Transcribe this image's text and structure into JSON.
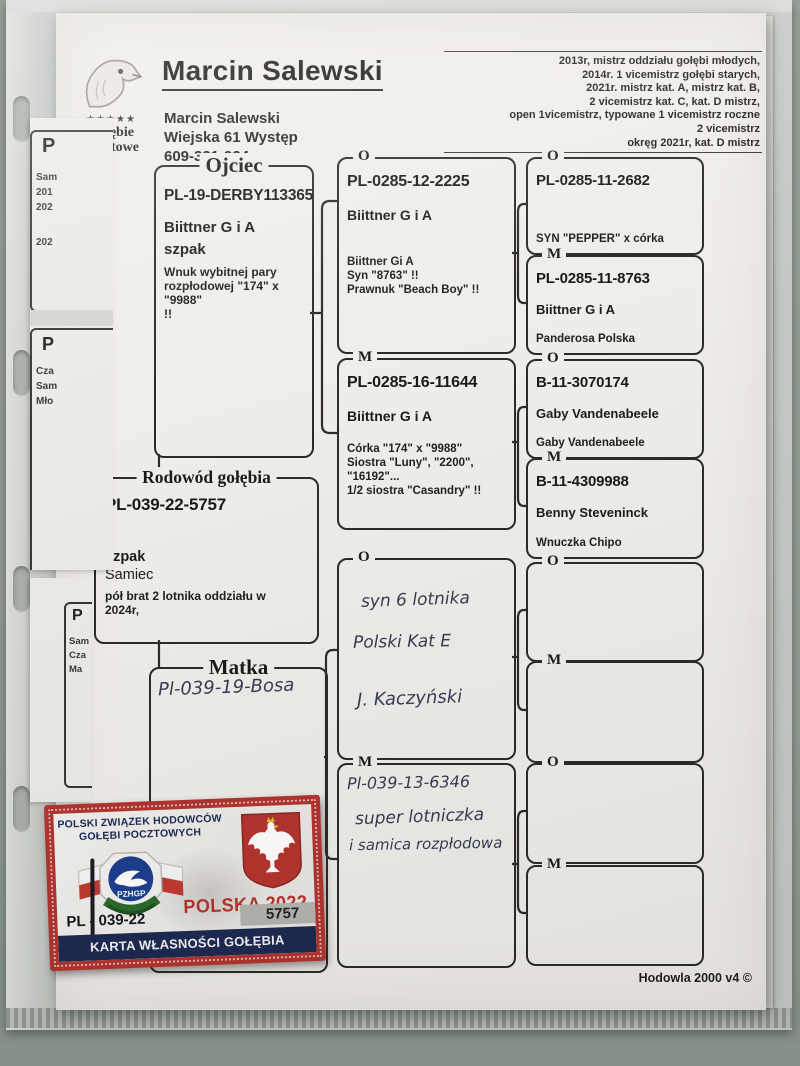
{
  "header": {
    "logo": {
      "stars": "★★★★★",
      "name_line1": "Gołębie",
      "name_line2": "Pocztowe"
    },
    "title": "Marcin Salewski",
    "address_lines": [
      "Marcin Salewski",
      "Wiejska 61 Występ",
      "609-331-924"
    ],
    "achievements": [
      "2013r, mistrz oddziału gołębi młodych,",
      "2014r. 1 vicemistrz gołębi starych,",
      "2021r. mistrz kat. A, mistrz kat. B,",
      "2 vicemistrz kat. C, kat. D mistrz,",
      "open 1vicemistrz, typowane 1 vicemistrz roczne",
      "2 vicemistrz",
      "okręg 2021r, kat. D mistrz"
    ]
  },
  "pedigree": {
    "subject": {
      "legend": "Rodowód gołębia",
      "ring": "PL-039-22-5757",
      "color": "szpak",
      "sex": "Samiec",
      "note_lines": [
        "pół brat 2 lotnika oddziału w",
        "2024r,"
      ]
    },
    "father": {
      "legend": "Ojciec",
      "ring": "PL-19-DERBY113365",
      "strain": "Biittner G i A",
      "color": "szpak",
      "note_lines": [
        "Wnuk wybitnej pary",
        "rozpłodowej \"174\" x \"9988\"",
        "!!"
      ]
    },
    "mother": {
      "legend": "Matka",
      "handwritten": "Pl-039-19-Bosa"
    },
    "gen2": [
      {
        "legend": "O",
        "ring": "PL-0285-12-2225",
        "strain": "Biittner G i A",
        "notes": [
          "Biittner Gi A",
          "Syn \"8763\" !!",
          "Prawnuk \"Beach Boy\" !!"
        ]
      },
      {
        "legend": "M",
        "ring": "PL-0285-16-11644",
        "strain": "Biittner G i A",
        "notes": [
          "Córka \"174\" x \"9988\"",
          "Siostra \"Luny\", \"2200\",",
          "\"16192\"...",
          "1/2 siostra \"Casandry\" !!"
        ]
      },
      {
        "legend": "O",
        "handwritten": [
          "syn 6 lotnika",
          "Polski Kat E",
          "J. Kaczyński"
        ]
      },
      {
        "legend": "M",
        "handwritten": [
          "Pl-039-13-6346",
          "super lotniczka",
          "i samica rozpłodowa"
        ]
      }
    ],
    "gen3": [
      {
        "legend": "O",
        "ring": "PL-0285-11-2682",
        "note": "SYN \"PEPPER\" x córka"
      },
      {
        "legend": "M",
        "ring": "PL-0285-11-8763",
        "strain": "Biittner G i A",
        "note": "Panderosa Polska"
      },
      {
        "legend": "O",
        "ring": "B-11-3070174",
        "strain": "Gaby Vandenabeele",
        "note": "Gaby Vandenabeele"
      },
      {
        "legend": "M",
        "ring": "B-11-4309988",
        "strain": "Benny Steveninck",
        "note": "Wnuczka Chipo"
      },
      {
        "legend": "O"
      },
      {
        "legend": "M"
      },
      {
        "legend": "O"
      },
      {
        "legend": "M"
      }
    ]
  },
  "card": {
    "association_line1": "POLSKI ZWIĄZEK HODOWCÓW",
    "association_line2": "GOŁĘBI POCZTOWYCH",
    "logo_text": "PZHGP",
    "country_year": "POLSKA 2022",
    "ring_prefix": "PL - 039-22",
    "ring_number": "5757",
    "banner": "KARTA WŁASNOŚCI GOŁĘBIA POCZTOWEGO"
  },
  "footer": {
    "credit": "Hodowla 2000 v4 ©"
  },
  "left_sheets": {
    "box1": {
      "heading": "P",
      "lines": [
        "Sam",
        "201",
        "202",
        "202"
      ]
    },
    "box2": {
      "heading": "P",
      "lines": [
        "Cza",
        "Sam",
        "Mło"
      ]
    },
    "box3": {
      "heading": "P",
      "lines": [
        "Sam",
        "Cza",
        "Ma"
      ]
    }
  },
  "colors": {
    "card_red": "#b23530",
    "card_navy": "#1e2a52",
    "accent_red": "#b5352f",
    "ink_blue": "#373e55"
  }
}
